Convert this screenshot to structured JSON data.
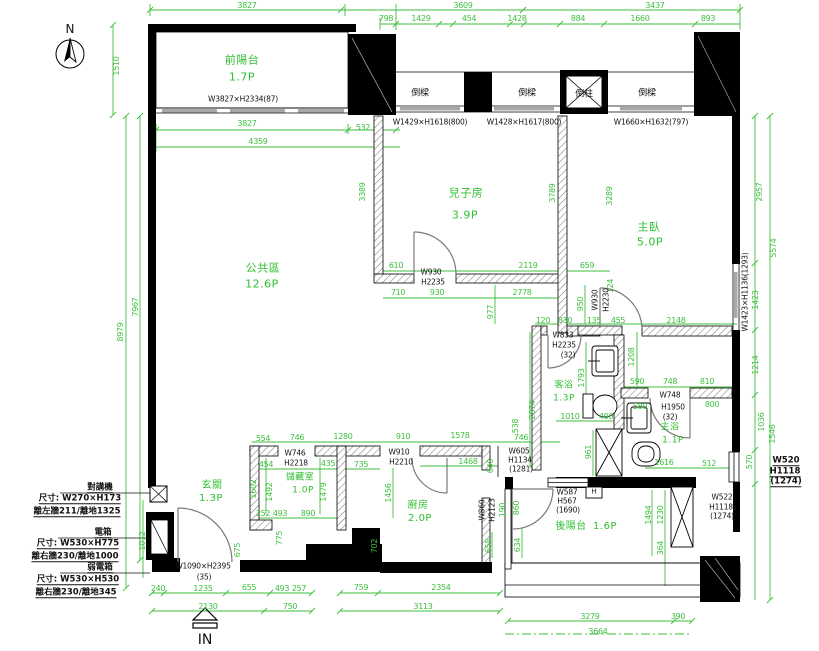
{
  "drawing": {
    "colors": {
      "dim_green": "#3cbf3c",
      "wall_black": "#000000",
      "hatch_gray": "#777777"
    },
    "compass_label": "N",
    "entry_label": "IN",
    "rooms": [
      {
        "label": "前陽台",
        "area": "1.7P"
      },
      {
        "label": "公共區",
        "area": "12.6P"
      },
      {
        "label": "兒子房",
        "area": "3.9P"
      },
      {
        "label": "主臥",
        "area": "5.0P"
      },
      {
        "label": "客浴",
        "area": "1.3P"
      },
      {
        "label": "主浴",
        "area": "1.1P"
      },
      {
        "label": "玄關",
        "area": "1.3P"
      },
      {
        "label": "儲藏室",
        "area": "1.0P"
      },
      {
        "label": "廚房",
        "area": "2.0P"
      },
      {
        "label": "後陽台",
        "area": "1.6P"
      }
    ],
    "labels": [
      {
        "t": "3827",
        "x": 247,
        "y": 6,
        "k": "g"
      },
      {
        "t": "3609",
        "x": 463,
        "y": 6,
        "k": "g"
      },
      {
        "t": "3437",
        "x": 655,
        "y": 6,
        "k": "g"
      },
      {
        "t": "798",
        "x": 386,
        "y": 19,
        "k": "g"
      },
      {
        "t": "1429",
        "x": 421,
        "y": 19,
        "k": "g"
      },
      {
        "t": "454",
        "x": 469,
        "y": 19,
        "k": "g"
      },
      {
        "t": "1428",
        "x": 517,
        "y": 19,
        "k": "g"
      },
      {
        "t": "884",
        "x": 578,
        "y": 19,
        "k": "g"
      },
      {
        "t": "1660",
        "x": 640,
        "y": 19,
        "k": "g"
      },
      {
        "t": "893",
        "x": 708,
        "y": 19,
        "k": "g"
      },
      {
        "t": "1510",
        "x": 117,
        "y": 66,
        "k": "g",
        "r": -90
      },
      {
        "t": "3827",
        "x": 247,
        "y": 124,
        "k": "g"
      },
      {
        "t": "532",
        "x": 363,
        "y": 128,
        "k": "g"
      },
      {
        "t": "4359",
        "x": 258,
        "y": 142,
        "k": "g"
      },
      {
        "t": "8979",
        "x": 121,
        "y": 332,
        "k": "g",
        "r": -90
      },
      {
        "t": "7967",
        "x": 136,
        "y": 307,
        "k": "g",
        "r": -90
      },
      {
        "t": "3389",
        "x": 363,
        "y": 192,
        "k": "g",
        "r": -90
      },
      {
        "t": "3789",
        "x": 553,
        "y": 193,
        "k": "g",
        "r": -90
      },
      {
        "t": "3289",
        "x": 610,
        "y": 196,
        "k": "g",
        "r": -90
      },
      {
        "t": "2957",
        "x": 760,
        "y": 192,
        "k": "g",
        "r": -90
      },
      {
        "t": "5574",
        "x": 774,
        "y": 248,
        "k": "g",
        "r": -90
      },
      {
        "t": "1423",
        "x": 756,
        "y": 300,
        "k": "g",
        "r": -90
      },
      {
        "t": "610",
        "x": 396,
        "y": 266,
        "k": "g"
      },
      {
        "t": "2119",
        "x": 528,
        "y": 266,
        "k": "g"
      },
      {
        "t": "659",
        "x": 587,
        "y": 266,
        "k": "g"
      },
      {
        "t": "710",
        "x": 398,
        "y": 293,
        "k": "g"
      },
      {
        "t": "930",
        "x": 437,
        "y": 293,
        "k": "g"
      },
      {
        "t": "2778",
        "x": 522,
        "y": 293,
        "k": "g"
      },
      {
        "t": "977",
        "x": 491,
        "y": 312,
        "k": "g",
        "r": -90
      },
      {
        "t": "950",
        "x": 581,
        "y": 304,
        "k": "g",
        "r": -90
      },
      {
        "t": "124",
        "x": 611,
        "y": 286,
        "k": "g",
        "r": -90
      },
      {
        "t": "120",
        "x": 543,
        "y": 321,
        "k": "g"
      },
      {
        "t": "830",
        "x": 565,
        "y": 321,
        "k": "g"
      },
      {
        "t": "135",
        "x": 594,
        "y": 321,
        "k": "g"
      },
      {
        "t": "455",
        "x": 618,
        "y": 321,
        "k": "g"
      },
      {
        "t": "2148",
        "x": 676,
        "y": 321,
        "k": "g"
      },
      {
        "t": "1793",
        "x": 582,
        "y": 378,
        "k": "g",
        "r": -90
      },
      {
        "t": "1208",
        "x": 632,
        "y": 357,
        "k": "g",
        "r": -90
      },
      {
        "t": "2874",
        "x": 533,
        "y": 410,
        "k": "g",
        "r": -90
      },
      {
        "t": "1010",
        "x": 570,
        "y": 417,
        "k": "g"
      },
      {
        "t": "400",
        "x": 606,
        "y": 417,
        "k": "g"
      },
      {
        "t": "590",
        "x": 637,
        "y": 382,
        "k": "g"
      },
      {
        "t": "748",
        "x": 670,
        "y": 382,
        "k": "g"
      },
      {
        "t": "810",
        "x": 707,
        "y": 382,
        "k": "g"
      },
      {
        "t": "580",
        "x": 640,
        "y": 407,
        "k": "g"
      },
      {
        "t": "800",
        "x": 712,
        "y": 405,
        "k": "g"
      },
      {
        "t": "961",
        "x": 589,
        "y": 452,
        "k": "g",
        "r": -90
      },
      {
        "t": "1616",
        "x": 664,
        "y": 463,
        "k": "g"
      },
      {
        "t": "512",
        "x": 709,
        "y": 464,
        "k": "g"
      },
      {
        "t": "1214",
        "x": 756,
        "y": 365,
        "k": "g",
        "r": -90
      },
      {
        "t": "1036",
        "x": 762,
        "y": 422,
        "k": "g",
        "r": -90
      },
      {
        "t": "1546",
        "x": 773,
        "y": 434,
        "k": "g",
        "r": -90
      },
      {
        "t": "570",
        "x": 750,
        "y": 462,
        "k": "g",
        "r": -90
      },
      {
        "t": "554",
        "x": 263,
        "y": 439,
        "k": "g"
      },
      {
        "t": "746",
        "x": 297,
        "y": 438,
        "k": "g"
      },
      {
        "t": "1280",
        "x": 343,
        "y": 437,
        "k": "g"
      },
      {
        "t": "454",
        "x": 266,
        "y": 465,
        "k": "g"
      },
      {
        "t": "435",
        "x": 328,
        "y": 464,
        "k": "g"
      },
      {
        "t": "1602",
        "x": 254,
        "y": 489,
        "k": "g",
        "r": -90
      },
      {
        "t": "1492",
        "x": 270,
        "y": 492,
        "k": "g",
        "r": -90
      },
      {
        "t": "1479",
        "x": 324,
        "y": 492,
        "k": "g",
        "r": -90
      },
      {
        "t": "252",
        "x": 263,
        "y": 514,
        "k": "g"
      },
      {
        "t": "493",
        "x": 280,
        "y": 514,
        "k": "g"
      },
      {
        "t": "890",
        "x": 308,
        "y": 514,
        "k": "g"
      },
      {
        "t": "675",
        "x": 238,
        "y": 550,
        "k": "g",
        "r": -90
      },
      {
        "t": "775",
        "x": 280,
        "y": 538,
        "k": "g",
        "r": -90
      },
      {
        "t": "1012",
        "x": 143,
        "y": 541,
        "k": "g",
        "r": -90
      },
      {
        "t": "910",
        "x": 403,
        "y": 437,
        "k": "g"
      },
      {
        "t": "1578",
        "x": 460,
        "y": 436,
        "k": "g"
      },
      {
        "t": "735",
        "x": 361,
        "y": 465,
        "k": "g"
      },
      {
        "t": "1468",
        "x": 468,
        "y": 462,
        "k": "g"
      },
      {
        "t": "538",
        "x": 516,
        "y": 426,
        "k": "g",
        "r": -90
      },
      {
        "t": "1456",
        "x": 389,
        "y": 493,
        "k": "g",
        "r": -90
      },
      {
        "t": "640",
        "x": 491,
        "y": 466,
        "k": "g",
        "r": -90
      },
      {
        "t": "190",
        "x": 503,
        "y": 510,
        "k": "g",
        "r": -90
      },
      {
        "t": "860",
        "x": 517,
        "y": 508,
        "k": "g",
        "r": -90
      },
      {
        "t": "702",
        "x": 375,
        "y": 546,
        "k": "g",
        "r": -90
      },
      {
        "t": "658",
        "x": 489,
        "y": 546,
        "k": "g",
        "r": -90
      },
      {
        "t": "634",
        "x": 518,
        "y": 545,
        "k": "g",
        "r": -90
      },
      {
        "t": "746",
        "x": 521,
        "y": 438,
        "k": "g"
      },
      {
        "t": "1494",
        "x": 649,
        "y": 515,
        "k": "g",
        "r": -90
      },
      {
        "t": "1230",
        "x": 661,
        "y": 515,
        "k": "g",
        "r": -90
      },
      {
        "t": "364",
        "x": 661,
        "y": 548,
        "k": "g",
        "r": -90
      },
      {
        "t": "240",
        "x": 158,
        "y": 589,
        "k": "g"
      },
      {
        "t": "1235",
        "x": 203,
        "y": 589,
        "k": "g"
      },
      {
        "t": "655",
        "x": 249,
        "y": 588,
        "k": "g"
      },
      {
        "t": "493",
        "x": 282,
        "y": 589,
        "k": "g"
      },
      {
        "t": "257",
        "x": 299,
        "y": 589,
        "k": "g"
      },
      {
        "t": "2130",
        "x": 208,
        "y": 607,
        "k": "g"
      },
      {
        "t": "750",
        "x": 290,
        "y": 607,
        "k": "g"
      },
      {
        "t": "759",
        "x": 361,
        "y": 588,
        "k": "g"
      },
      {
        "t": "2354",
        "x": 441,
        "y": 588,
        "k": "g"
      },
      {
        "t": "3113",
        "x": 423,
        "y": 607,
        "k": "g"
      },
      {
        "t": "3279",
        "x": 590,
        "y": 617,
        "k": "g"
      },
      {
        "t": "390",
        "x": 678,
        "y": 617,
        "k": "g"
      },
      {
        "t": "3664",
        "x": 598,
        "y": 632,
        "k": "g"
      },
      {
        "t": "前陽台",
        "x": 242,
        "y": 60,
        "k": "gr",
        "n": "room-label-front-balcony"
      },
      {
        "t": "1.7P",
        "x": 242,
        "y": 77,
        "k": "gr"
      },
      {
        "t": "公共區",
        "x": 263,
        "y": 268,
        "k": "gr",
        "n": "room-label-public-area"
      },
      {
        "t": "12.6P",
        "x": 262,
        "y": 284,
        "k": "gr"
      },
      {
        "t": "兒子房",
        "x": 466,
        "y": 193,
        "k": "gr",
        "n": "room-label-sons-room"
      },
      {
        "t": "3.9P",
        "x": 465,
        "y": 215,
        "k": "gr"
      },
      {
        "t": "主臥",
        "x": 649,
        "y": 227,
        "k": "gr",
        "n": "room-label-master-bedroom"
      },
      {
        "t": "5.0P",
        "x": 650,
        "y": 242,
        "k": "gr"
      },
      {
        "t": "客浴",
        "x": 564,
        "y": 386,
        "k": "gr",
        "s": 9,
        "n": "room-label-guest-bath"
      },
      {
        "t": "1.3P",
        "x": 564,
        "y": 399,
        "k": "gr",
        "s": 9
      },
      {
        "t": "主浴",
        "x": 670,
        "y": 428,
        "k": "gr",
        "s": 9,
        "n": "room-label-master-bath"
      },
      {
        "t": "1.1P",
        "x": 673,
        "y": 441,
        "k": "gr",
        "s": 9
      },
      {
        "t": "玄關",
        "x": 212,
        "y": 486,
        "k": "gr",
        "s": 10,
        "n": "room-label-entry"
      },
      {
        "t": "1.3P",
        "x": 211,
        "y": 499,
        "k": "gr",
        "s": 10
      },
      {
        "t": "儲藏室",
        "x": 300,
        "y": 478,
        "k": "gr",
        "s": 9,
        "n": "room-label-storage"
      },
      {
        "t": "1.0P",
        "x": 303,
        "y": 491,
        "k": "gr",
        "s": 9
      },
      {
        "t": "廚房",
        "x": 418,
        "y": 506,
        "k": "gr",
        "s": 10,
        "n": "room-label-kitchen"
      },
      {
        "t": "2.0P",
        "x": 420,
        "y": 519,
        "k": "gr",
        "s": 10
      },
      {
        "t": "後陽台",
        "x": 571,
        "y": 527,
        "k": "gr",
        "s": 10,
        "n": "room-label-rear-balcony"
      },
      {
        "t": "1.6P",
        "x": 605,
        "y": 527,
        "k": "gr",
        "s": 10
      },
      {
        "t": "W3827×H2334(87)",
        "x": 243,
        "y": 99,
        "k": "k"
      },
      {
        "t": "倒樑",
        "x": 420,
        "y": 94,
        "k": "k",
        "s": 9
      },
      {
        "t": "倒樑",
        "x": 527,
        "y": 94,
        "k": "k",
        "s": 9
      },
      {
        "t": "倒柱",
        "x": 584,
        "y": 95,
        "k": "k",
        "s": 9
      },
      {
        "t": "倒樑",
        "x": 647,
        "y": 94,
        "k": "k",
        "s": 9
      },
      {
        "t": "W1429×H1618(800)",
        "x": 430,
        "y": 122,
        "k": "k"
      },
      {
        "t": "W1428×H1617(800)",
        "x": 524,
        "y": 122,
        "k": "k"
      },
      {
        "t": "W1660×H1632(797)",
        "x": 651,
        "y": 122,
        "k": "k"
      },
      {
        "t": "W930",
        "x": 431,
        "y": 272,
        "k": "k"
      },
      {
        "t": "H2235",
        "x": 433,
        "y": 282,
        "k": "k"
      },
      {
        "t": "W930",
        "x": 595,
        "y": 300,
        "k": "k",
        "r": -90
      },
      {
        "t": "H2230",
        "x": 606,
        "y": 300,
        "k": "k",
        "r": -90
      },
      {
        "t": "W1423×H1136(1293)",
        "x": 745,
        "y": 292,
        "k": "k",
        "r": -90
      },
      {
        "t": "W833",
        "x": 563,
        "y": 335,
        "k": "k"
      },
      {
        "t": "H2235",
        "x": 564,
        "y": 345,
        "k": "k"
      },
      {
        "t": "(32)",
        "x": 568,
        "y": 355,
        "k": "k"
      },
      {
        "t": "W748",
        "x": 670,
        "y": 395,
        "k": "k"
      },
      {
        "t": "H1950",
        "x": 673,
        "y": 407,
        "k": "k"
      },
      {
        "t": "(32)",
        "x": 670,
        "y": 417,
        "k": "k"
      },
      {
        "t": "W746",
        "x": 295,
        "y": 453,
        "k": "k"
      },
      {
        "t": "H2218",
        "x": 296,
        "y": 463,
        "k": "k"
      },
      {
        "t": "W1090×H2395",
        "x": 203,
        "y": 566,
        "k": "k"
      },
      {
        "t": "(35)",
        "x": 204,
        "y": 577,
        "k": "k"
      },
      {
        "t": "W910",
        "x": 399,
        "y": 452,
        "k": "k"
      },
      {
        "t": "H2210",
        "x": 401,
        "y": 462,
        "k": "k"
      },
      {
        "t": "W605",
        "x": 519,
        "y": 451,
        "k": "k"
      },
      {
        "t": "H1134",
        "x": 520,
        "y": 460,
        "k": "k"
      },
      {
        "t": "(1281)",
        "x": 521,
        "y": 469,
        "k": "k"
      },
      {
        "t": "W860",
        "x": 482,
        "y": 510,
        "k": "k",
        "r": -90
      },
      {
        "t": "H2123",
        "x": 492,
        "y": 510,
        "k": "k",
        "r": -90
      },
      {
        "t": "W587",
        "x": 567,
        "y": 492,
        "k": "k"
      },
      {
        "t": "H567",
        "x": 567,
        "y": 501,
        "k": "k"
      },
      {
        "t": "(1690)",
        "x": 568,
        "y": 510,
        "k": "k"
      },
      {
        "t": "H",
        "x": 594,
        "y": 492,
        "k": "k",
        "s": 7,
        "n": "h-box-label"
      },
      {
        "t": "W520",
        "x": 786,
        "y": 461,
        "k": "ku"
      },
      {
        "t": "H1118",
        "x": 785,
        "y": 472,
        "k": "ku"
      },
      {
        "t": "(1274)",
        "x": 786,
        "y": 482,
        "k": "ku"
      },
      {
        "t": "W522",
        "x": 722,
        "y": 497,
        "k": "k"
      },
      {
        "t": "H1118",
        "x": 721,
        "y": 507,
        "k": "k"
      },
      {
        "t": "(1274)",
        "x": 722,
        "y": 516,
        "k": "k"
      },
      {
        "t": "N",
        "x": 70,
        "y": 29,
        "k": "kb",
        "n": "compass-north-label"
      },
      {
        "t": "IN",
        "x": 205,
        "y": 640,
        "k": "kb",
        "s": 14,
        "n": "entry-direction-label"
      },
      {
        "t": "對講機",
        "x": 100,
        "y": 488,
        "k": "ku",
        "n": "note-intercom-title"
      },
      {
        "t": "尺寸: W270×H173",
        "x": 80,
        "y": 499,
        "k": "ku"
      },
      {
        "t": "離左牆211/離地1325",
        "x": 77,
        "y": 512,
        "k": "ku"
      },
      {
        "t": "電箱",
        "x": 103,
        "y": 533,
        "k": "ku",
        "n": "note-power-box-title"
      },
      {
        "t": "尺寸: W530×H775",
        "x": 78,
        "y": 544,
        "k": "ku"
      },
      {
        "t": "離右牆230/離地1000",
        "x": 75,
        "y": 557,
        "k": "ku"
      },
      {
        "t": "弱電箱",
        "x": 100,
        "y": 568,
        "k": "ku",
        "n": "note-lv-box-title"
      },
      {
        "t": "尺寸: W530×H530",
        "x": 78,
        "y": 580,
        "k": "ku"
      },
      {
        "t": "離右牆230/離地345",
        "x": 76,
        "y": 593,
        "k": "ku"
      }
    ]
  }
}
